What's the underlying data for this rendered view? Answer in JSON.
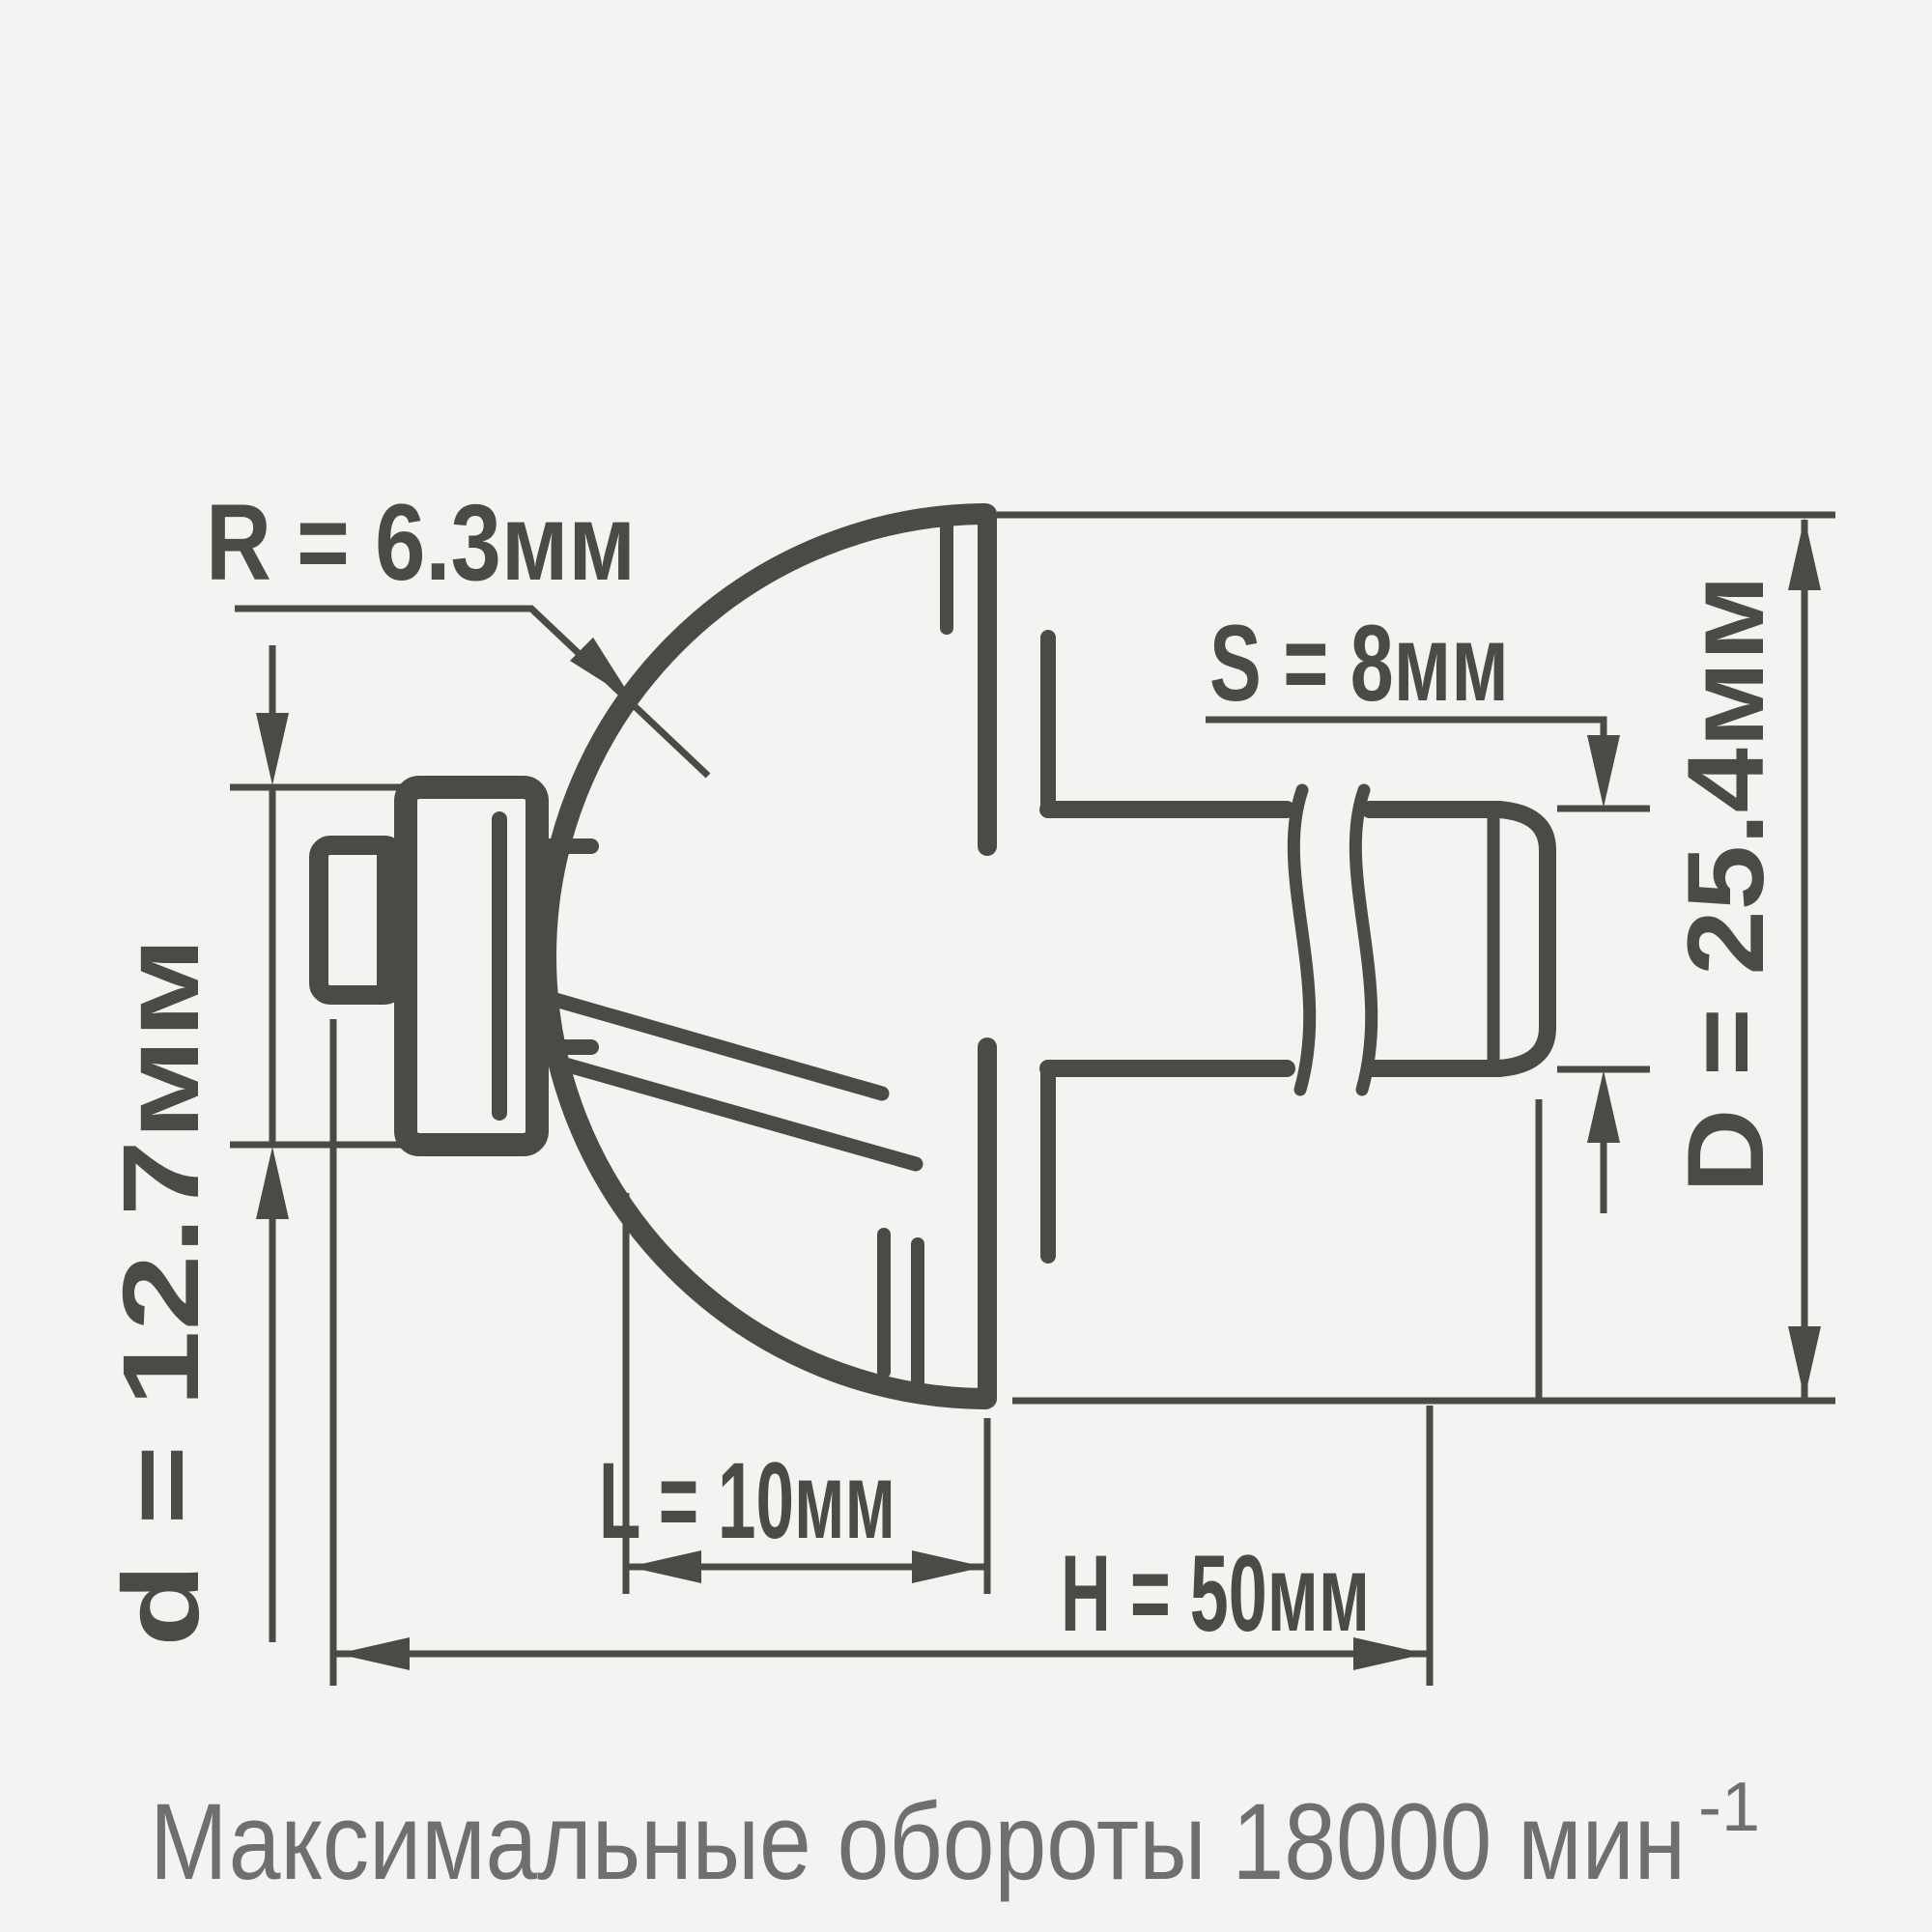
{
  "drawing": {
    "labels": {
      "radius": "R = 6.3мм",
      "shank": "S = 8мм",
      "diameter": "D = 25.4мм",
      "bearing": "d = 12.7мм",
      "length": "L = 10мм",
      "overall": "H = 50мм"
    },
    "colors": {
      "line": "#4b4a47",
      "caption": "#6f6f6f",
      "background": "#f4f3f1"
    }
  },
  "caption": {
    "text": "Максимальные обороты 18000 мин",
    "superscript": "-1"
  }
}
